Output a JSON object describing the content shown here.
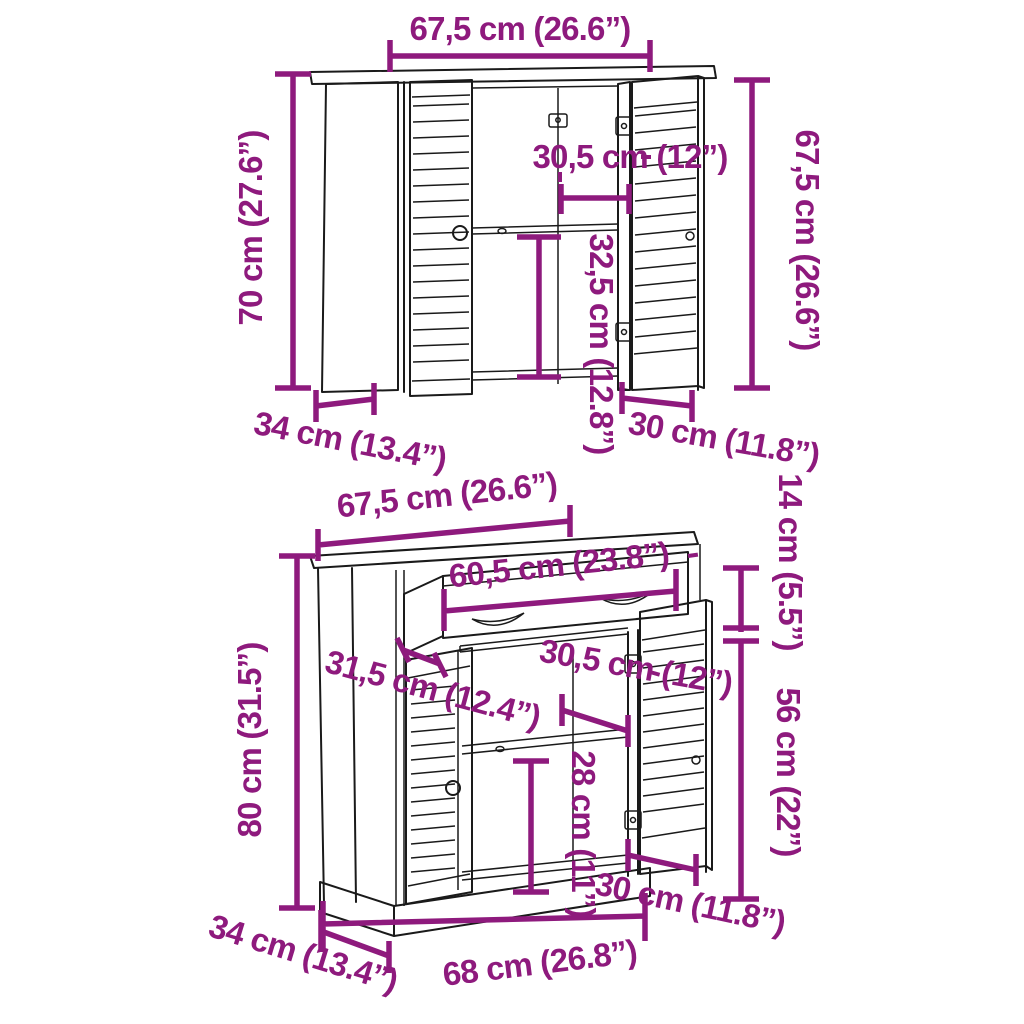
{
  "diagram": {
    "type": "furniture-dimension-diagram",
    "background": "#ffffff",
    "accent_color": "#8E1A7D",
    "line_color": "#1a1a1a",
    "cabinets": [
      {
        "name": "wall cabinet with louvered doors",
        "dimensions": {
          "top_width": "67,5 cm (26.6”)",
          "left_height": "70 cm (27.6”)",
          "right_height": "67,5 cm (26.6”)",
          "compartment_width": "30,5 cm (12”)",
          "compartment_height": "32,5 cm (12.8”)",
          "depth": "34 cm (13.4”)",
          "door_width": "30 cm (11.8”)"
        }
      },
      {
        "name": "sideboard with drawer and louvered doors",
        "dimensions": {
          "top_width": "67,5 cm (26.6”)",
          "drawer_width": "60,5 cm (23.8”)",
          "drawer_section_height": "14 cm (5.5”)",
          "drawer_depth": "31,5 cm (12.4”)",
          "compartment_width": "30,5 cm (12”)",
          "door_section_height": "56 cm (22”)",
          "compartment_height": "28 cm (11”)",
          "total_height": "80 cm (31.5”)",
          "depth": "34 cm (13.4”)",
          "bottom_width": "68 cm (26.8”)",
          "door_width": "30 cm (11.8”)"
        }
      }
    ]
  }
}
